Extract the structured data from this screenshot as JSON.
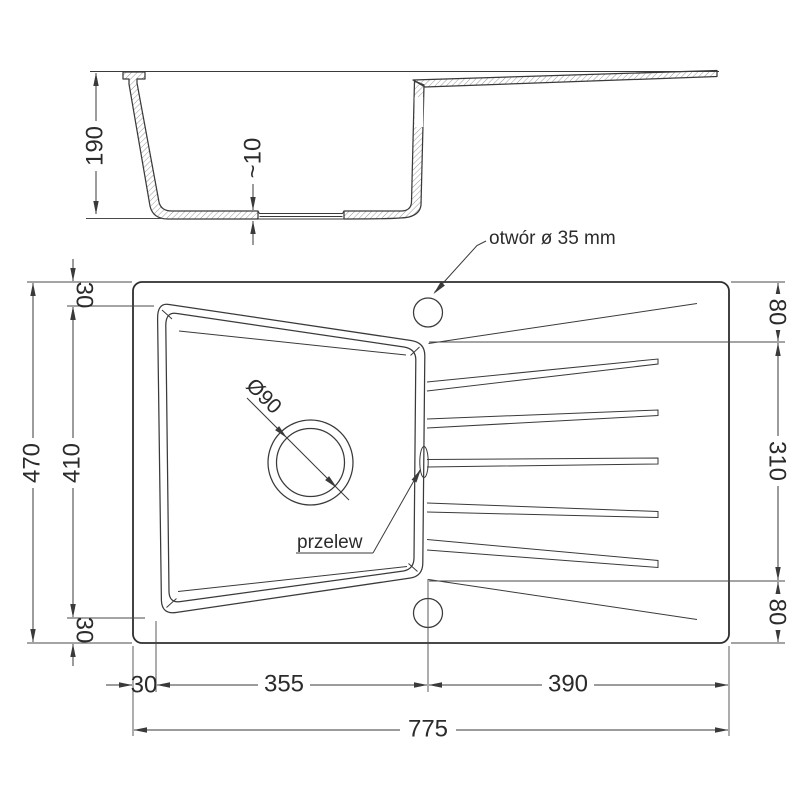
{
  "drawing_type": "sink technical drawing",
  "section": {
    "height": "190",
    "bottom_thickness": "~10"
  },
  "plan": {
    "faucet_hole_label": "otwór ø 35 mm",
    "overflow_label": "przelew",
    "drain_diameter_label": "Ø90"
  },
  "dims": {
    "left_total": "470",
    "left_bowl": "410",
    "left_top_offset": "30",
    "left_bottom_offset": "30",
    "right_top": "80",
    "right_middle": "310",
    "right_bottom": "80",
    "bottom_left_offset": "30",
    "bottom_bowl_width": "355",
    "bottom_drainer_width": "390",
    "bottom_total": "775"
  },
  "colors": {
    "line": "#3a3a3a",
    "outline": "#2e2e2e",
    "text": "#2b2b2b",
    "background": "#ffffff"
  }
}
